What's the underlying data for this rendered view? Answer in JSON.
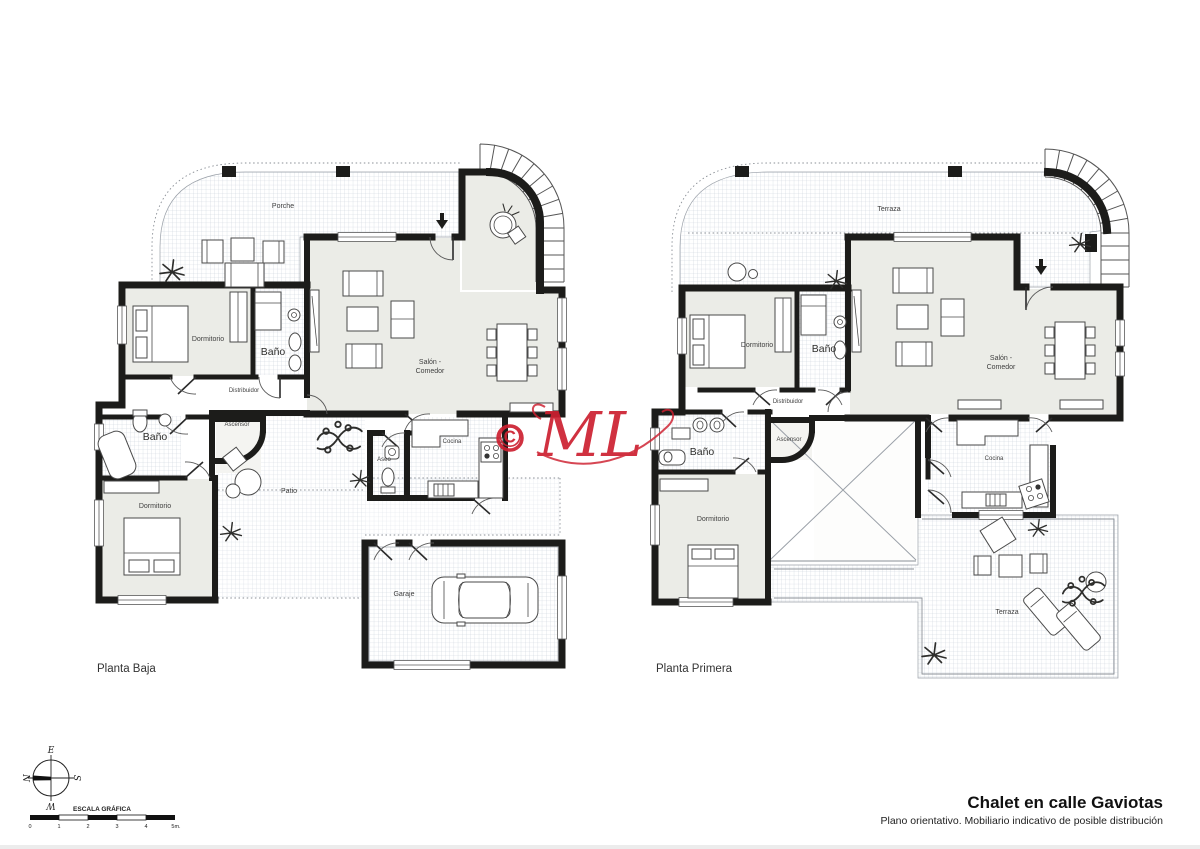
{
  "colors": {
    "wall": "#1c1c1a",
    "room_fill": "#ebece7",
    "hatch_line": "#c8cfda",
    "accent_red": "#cd2030",
    "label_text": "#3f3f3f"
  },
  "watermark": {
    "symbol": "©",
    "text": "ML"
  },
  "plans": [
    {
      "title": "Planta Baja",
      "rooms": {
        "porche": "Porche",
        "dormitorio_1": "Dormitorio",
        "bano_1": "Baño",
        "salon_1": "Salón -",
        "salon_2": "Comedor",
        "distribuidor": "Distribuidor",
        "ascensor": "Ascensor",
        "bano_2": "Baño",
        "dormitorio_2": "Dormitorio",
        "patio": "Patio",
        "aseo": "Aseo",
        "cocina": "Cocina",
        "garaje": "Garaje"
      }
    },
    {
      "title": "Planta Primera",
      "rooms": {
        "terraza": "Terraza",
        "dormitorio_1": "Dormitorio",
        "bano_1": "Baño",
        "salon_1": "Salón -",
        "salon_2": "Comedor",
        "distribuidor": "Distribuidor",
        "ascensor": "Ascensor",
        "bano_2": "Baño",
        "dormitorio_2": "Dormitorio",
        "cocina": "Cocina",
        "terraza_2": "Terraza"
      }
    }
  ],
  "compass": {
    "e": "E",
    "s": "S",
    "w": "W",
    "n": "N"
  },
  "scale_bar": {
    "label": "ESCALA GRÁFICA",
    "ticks": [
      "0",
      "1",
      "2",
      "3",
      "4",
      "5m."
    ]
  },
  "title_block": {
    "title": "Chalet en calle Gaviotas",
    "subtitle": "Plano orientativo. Mobiliario indicativo de posible distribución"
  }
}
